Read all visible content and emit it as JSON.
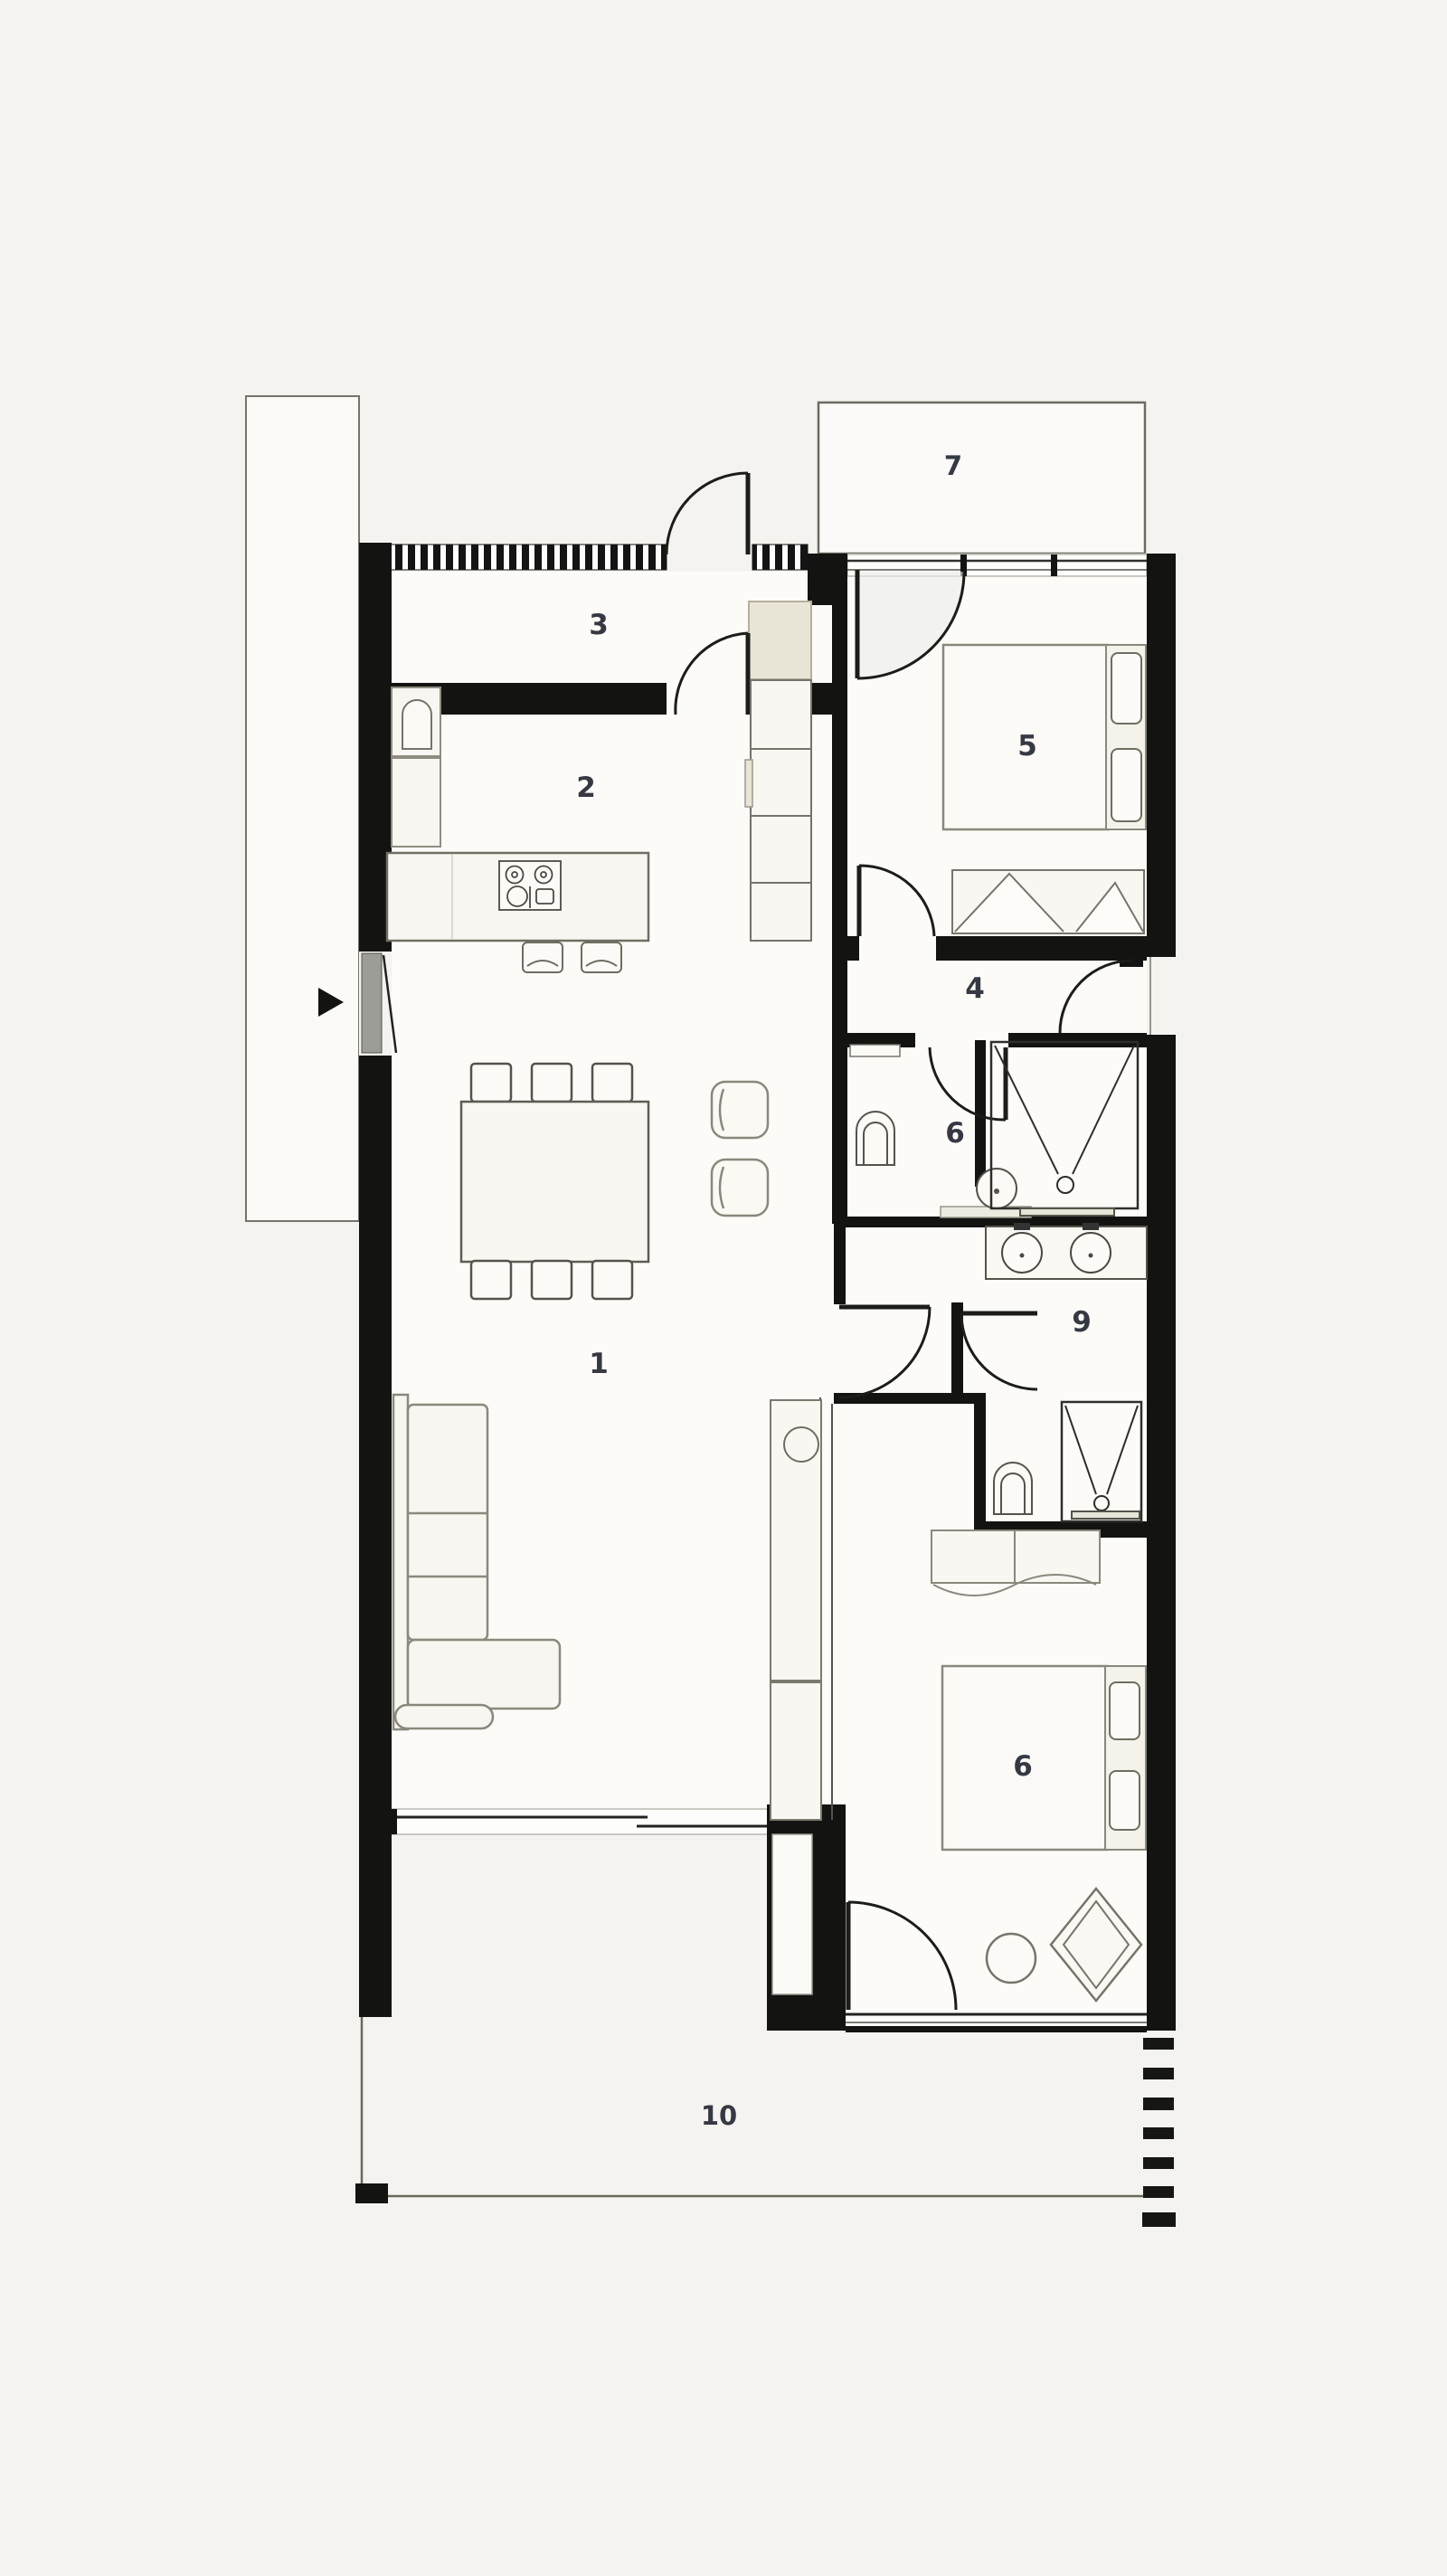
{
  "meta": {
    "type": "architectural floor plan",
    "style": "black and white minimal plan, top-down view",
    "units_labelled": 10
  },
  "rooms": [
    {
      "key": "living-room",
      "label": "1"
    },
    {
      "key": "kitchen-dining",
      "label": "2"
    },
    {
      "key": "entry-hall",
      "label": "3"
    },
    {
      "key": "hallway",
      "label": "4"
    },
    {
      "key": "bedroom-north",
      "label": "5"
    },
    {
      "key": "bathroom",
      "label": "6"
    },
    {
      "key": "balcony",
      "label": "7"
    },
    {
      "key": "bedroom-south",
      "label": "6"
    },
    {
      "key": "ensuite-bathroom",
      "label": "9"
    },
    {
      "key": "terrace",
      "label": "10"
    }
  ],
  "colors": {
    "background": "#f4f3ef",
    "floor": "#fcfbf8",
    "wall": "#131311",
    "thin_outline": "#76746a",
    "furniture_fill": "#f7f6f1",
    "shaft_fill": "#e9e5d6",
    "label": "#363943",
    "glass_line": "#2e2e2a"
  }
}
